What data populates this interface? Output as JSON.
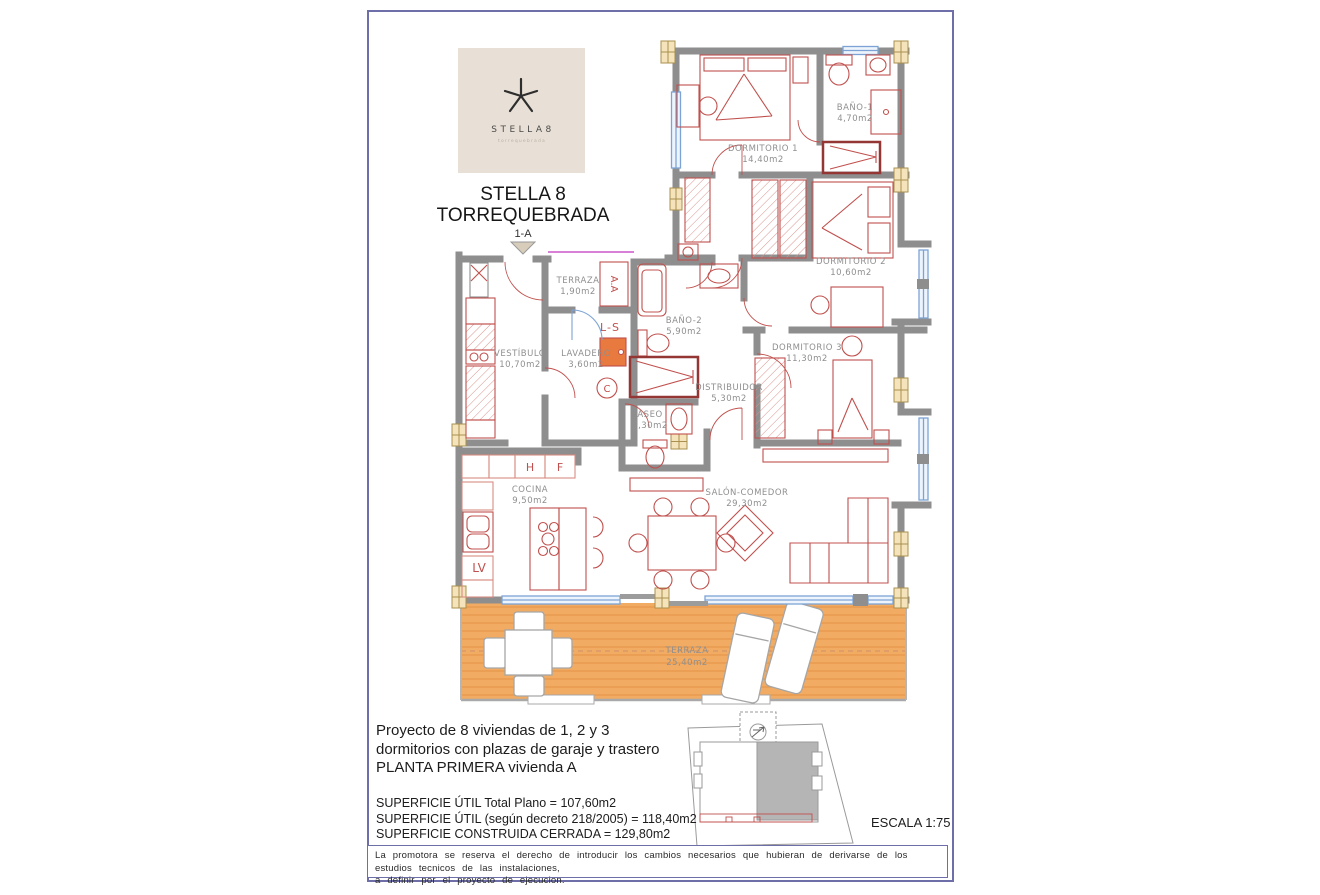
{
  "logo": {
    "brand": "STELLA8",
    "sub": "torrequebrada"
  },
  "title": {
    "line1": "STELLA 8",
    "line2": "TORREQUEBRADA"
  },
  "unit_marker": "1-A",
  "rooms": {
    "dormitorio1": {
      "name": "DORMITORIO 1",
      "area": "14,40m2"
    },
    "bano1": {
      "name": "BAÑO-1",
      "area": "4,70m2"
    },
    "dormitorio2": {
      "name": "DORMITORIO 2",
      "area": "10,60m2"
    },
    "dormitorio3": {
      "name": "DORMITORIO 3",
      "area": "11,30m2"
    },
    "terraza_peq": {
      "name": "TERRAZA",
      "area": "1,90m2"
    },
    "vestibulo": {
      "name": "VESTÍBULO",
      "area": "10,70m2"
    },
    "lavadero": {
      "name": "LAVADERO",
      "area": "3,60m2"
    },
    "bano2": {
      "name": "BAÑO-2",
      "area": "5,90m2"
    },
    "distribuidor": {
      "name": "DISTRIBUIDOR",
      "area": "5,30m2"
    },
    "aseo": {
      "name": "ASEO",
      "area": "2,30m2"
    },
    "cocina": {
      "name": "COCINA",
      "area": "9,50m2"
    },
    "salon": {
      "name": "SALÓN-COMEDOR",
      "area": "29,30m2"
    },
    "terraza_gr": {
      "name": "TERRAZA",
      "area": "25,40m2"
    }
  },
  "annotations": {
    "aa": "A.A",
    "ls": "L-S",
    "c": "C",
    "h": "H",
    "f": "F",
    "lv": "LV"
  },
  "footer": {
    "project_line1": "Proyecto de 8 viviendas de 1, 2 y 3",
    "project_line2": "dormitorios con plazas de garaje y trastero",
    "project_line3": "PLANTA PRIMERA vivienda A",
    "surface_line1": "SUPERFICIE ÚTIL Total Plano = 107,60m2",
    "surface_line2": "SUPERFICIE ÚTIL (según decreto 218/2005) = 118,40m2",
    "surface_line3": "SUPERFICIE CONSTRUIDA CERRADA = 129,80m2",
    "scale": "ESCALA  1:75",
    "disclaimer_line1": "La promotora se reserva el derecho de introducir los cambios necesarios que hubieran de derivarse de los estudios tecnicos de las instalaciones,",
    "disclaimer_line2": "a definir por el proyecto de ejecucion."
  },
  "colors": {
    "frame_border": "#6e6fa8",
    "wall_gray": "#8e8e8e",
    "furniture_red": "#c0504d",
    "shower_dark_red": "#943634",
    "window_blue": "#7da3d6",
    "terrace_orange": "#f2ab63",
    "pillar_beige": "#f5e3bb",
    "logo_beige": "#e8e0d6"
  }
}
